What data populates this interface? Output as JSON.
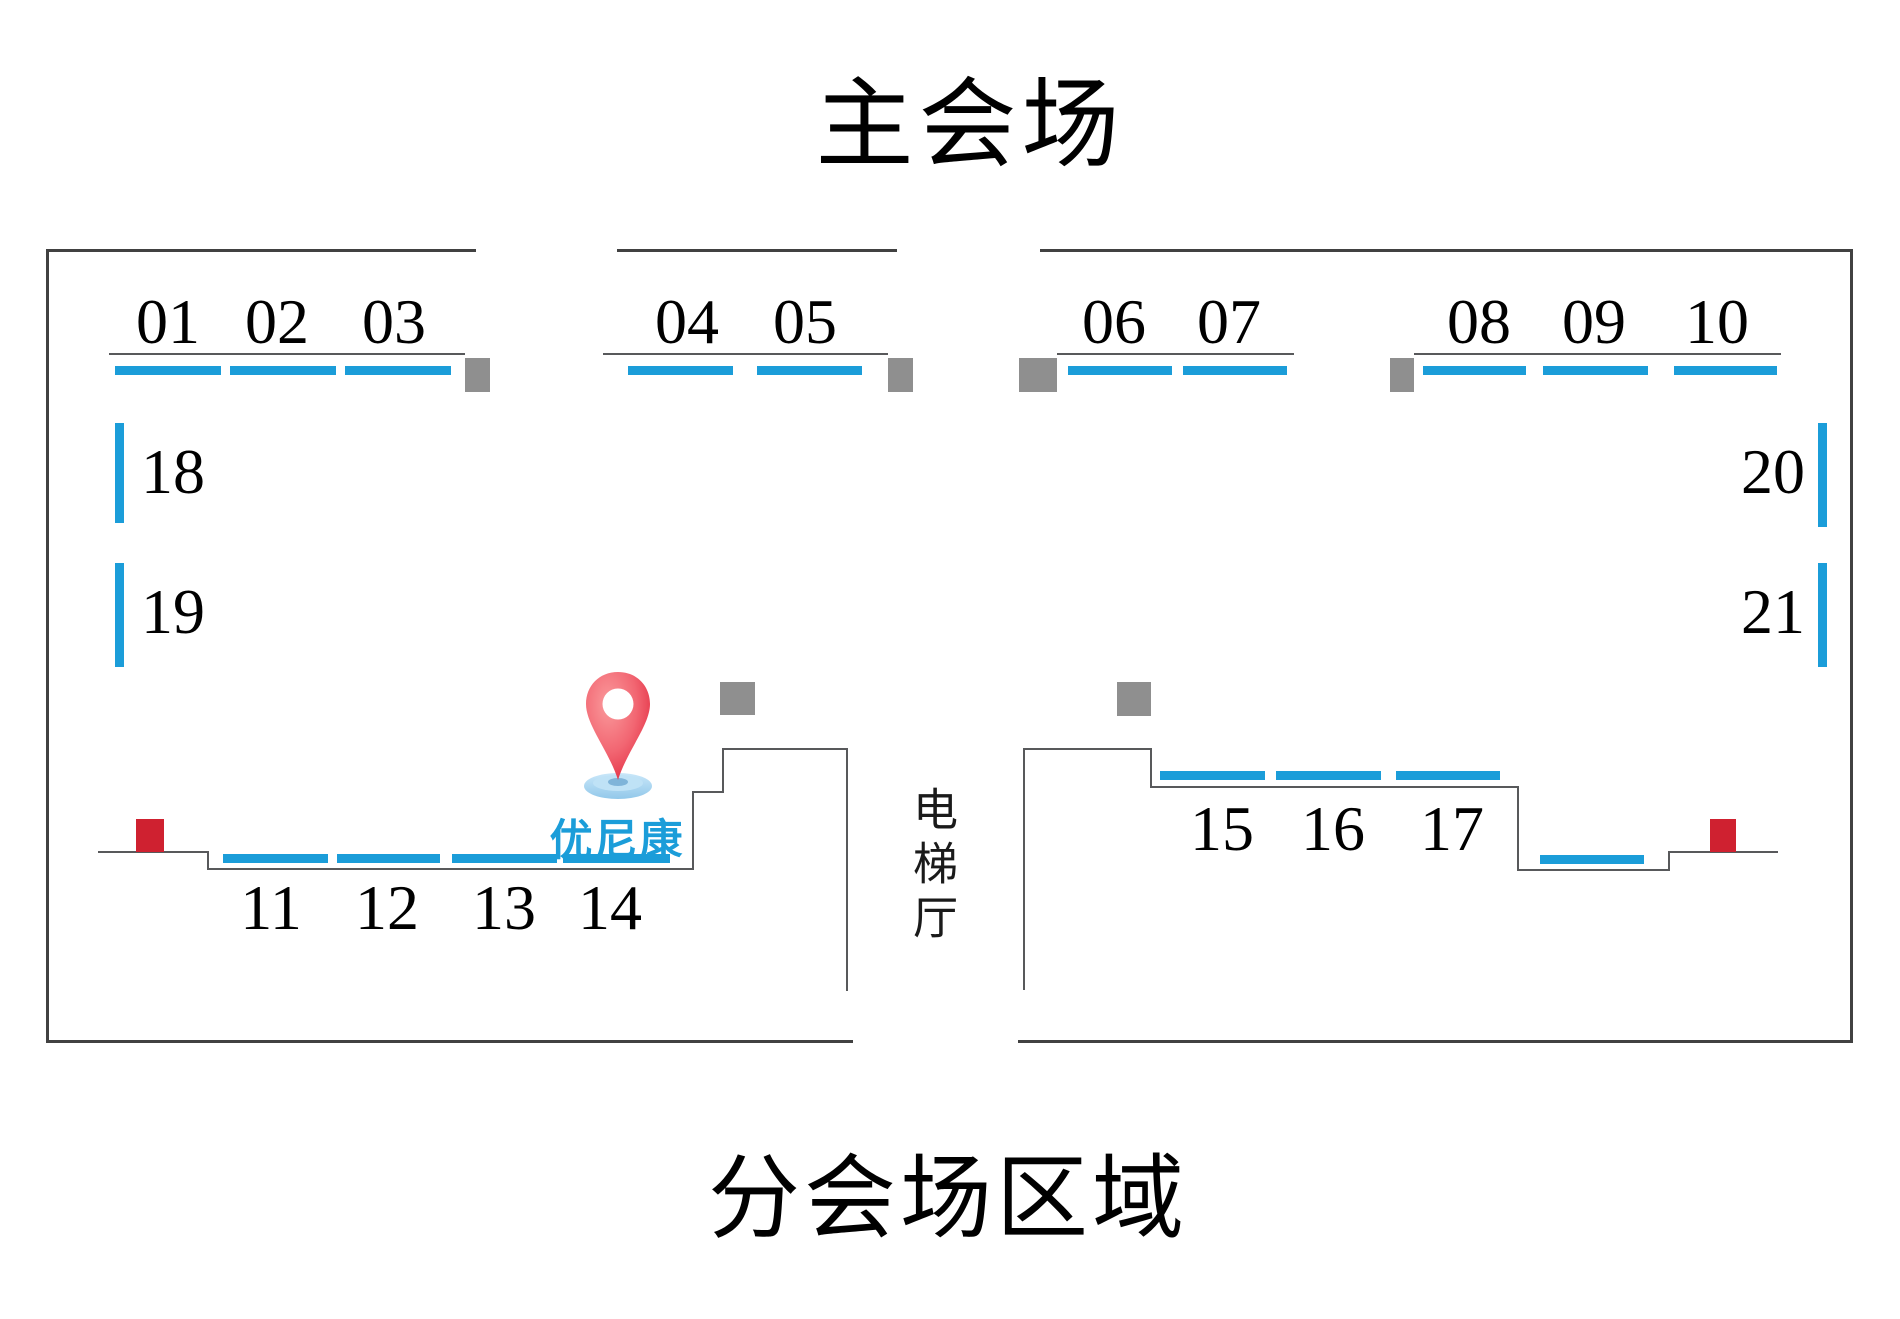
{
  "titles": {
    "main": "主会场",
    "footer": "分会场区域"
  },
  "elevator": {
    "label": "电梯厅"
  },
  "marker": {
    "company": "优尼康",
    "icon": "location-pin"
  },
  "colors": {
    "booth_blue": "#1b9dd9",
    "wall_outer": "#414141",
    "wall_inner": "#58595b",
    "gray_block": "#8f8f8f",
    "red_block": "#cf2130",
    "pin_red_light": "#fa8d90",
    "pin_red_dark": "#e22c41",
    "pin_base_blue": "#a6d6f2",
    "text_black": "#000000"
  },
  "floorplan": {
    "outer_walls": [
      [
        46,
        249,
        430,
        3
      ],
      [
        617,
        249,
        280,
        3
      ],
      [
        1040,
        249,
        813,
        3
      ],
      [
        46,
        249,
        3,
        794
      ],
      [
        1850,
        249,
        3,
        794
      ],
      [
        46,
        1040,
        807,
        3
      ],
      [
        1018,
        1040,
        835,
        3
      ]
    ],
    "inner_walls": [
      [
        109,
        353,
        356,
        2
      ],
      [
        603,
        353,
        285,
        2
      ],
      [
        1057,
        353,
        237,
        2
      ],
      [
        1414,
        353,
        367,
        2
      ],
      [
        98,
        851,
        110,
        2
      ],
      [
        207,
        851,
        2,
        19
      ],
      [
        207,
        868,
        487,
        2
      ],
      [
        692,
        793,
        2,
        77
      ],
      [
        692,
        791,
        32,
        2
      ],
      [
        722,
        750,
        2,
        43
      ],
      [
        722,
        748,
        126,
        2
      ],
      [
        846,
        750,
        2,
        241
      ],
      [
        1023,
        750,
        2,
        240
      ],
      [
        1023,
        748,
        129,
        2
      ],
      [
        1150,
        748,
        2,
        40
      ],
      [
        1150,
        786,
        368,
        2
      ],
      [
        1517,
        786,
        2,
        85
      ],
      [
        1517,
        869,
        153,
        2
      ],
      [
        1668,
        851,
        2,
        20
      ],
      [
        1668,
        851,
        110,
        2
      ]
    ],
    "gray_blocks": [
      [
        465,
        358,
        25,
        34
      ],
      [
        888,
        358,
        25,
        34
      ],
      [
        1019,
        358,
        38,
        34
      ],
      [
        1390,
        358,
        24,
        34
      ],
      [
        720,
        682,
        35,
        33
      ],
      [
        1117,
        682,
        34,
        34
      ]
    ],
    "red_blocks": [
      [
        136,
        819,
        28,
        33
      ],
      [
        1710,
        819,
        26,
        33
      ]
    ],
    "booths": [
      {
        "id": "01",
        "bar": [
          115,
          366,
          106,
          9
        ],
        "label_at": [
          168,
          290
        ],
        "align": "center"
      },
      {
        "id": "02",
        "bar": [
          230,
          366,
          106,
          9
        ],
        "label_at": [
          277,
          290
        ],
        "align": "center"
      },
      {
        "id": "03",
        "bar": [
          345,
          366,
          106,
          9
        ],
        "label_at": [
          394,
          290
        ],
        "align": "center"
      },
      {
        "id": "04",
        "bar": [
          628,
          366,
          105,
          9
        ],
        "label_at": [
          687,
          290
        ],
        "align": "center"
      },
      {
        "id": "05",
        "bar": [
          757,
          366,
          105,
          9
        ],
        "label_at": [
          805,
          290
        ],
        "align": "center"
      },
      {
        "id": "06",
        "bar": [
          1068,
          366,
          104,
          9
        ],
        "label_at": [
          1114,
          290
        ],
        "align": "center"
      },
      {
        "id": "07",
        "bar": [
          1183,
          366,
          104,
          9
        ],
        "label_at": [
          1229,
          290
        ],
        "align": "center"
      },
      {
        "id": "08",
        "bar": [
          1423,
          366,
          103,
          9
        ],
        "label_at": [
          1479,
          290
        ],
        "align": "center"
      },
      {
        "id": "09",
        "bar": [
          1543,
          366,
          105,
          9
        ],
        "label_at": [
          1594,
          290
        ],
        "align": "center"
      },
      {
        "id": "10",
        "bar": [
          1674,
          366,
          103,
          9
        ],
        "label_at": [
          1717,
          290
        ],
        "align": "center"
      },
      {
        "id": "18",
        "bar": [
          115,
          423,
          9,
          100
        ],
        "label_at": [
          141,
          440
        ],
        "align": "left"
      },
      {
        "id": "19",
        "bar": [
          115,
          563,
          9,
          104
        ],
        "label_at": [
          141,
          580
        ],
        "align": "left"
      },
      {
        "id": "20",
        "bar": [
          1818,
          423,
          9,
          104
        ],
        "label_at": [
          1741,
          440
        ],
        "align": "left"
      },
      {
        "id": "21",
        "bar": [
          1818,
          563,
          9,
          104
        ],
        "label_at": [
          1741,
          580
        ],
        "align": "left"
      },
      {
        "id": "11",
        "bar": [
          223,
          854,
          105,
          9
        ],
        "label_at": [
          271,
          876
        ],
        "align": "center"
      },
      {
        "id": "12",
        "bar": [
          337,
          854,
          103,
          9
        ],
        "label_at": [
          387,
          876
        ],
        "align": "center"
      },
      {
        "id": "13",
        "bar": [
          452,
          854,
          105,
          9
        ],
        "label_at": [
          504,
          876
        ],
        "align": "center"
      },
      {
        "id": "14",
        "bar": [
          563,
          854,
          107,
          9
        ],
        "label_at": [
          610,
          876
        ],
        "align": "center"
      },
      {
        "id": "15",
        "bar": [
          1160,
          771,
          105,
          9
        ],
        "label_at": [
          1222,
          797
        ],
        "align": "center"
      },
      {
        "id": "16",
        "bar": [
          1276,
          771,
          105,
          9
        ],
        "label_at": [
          1333,
          797
        ],
        "align": "center"
      },
      {
        "id": "17",
        "bar": [
          1396,
          771,
          104,
          9
        ],
        "label_at": [
          1452,
          797
        ],
        "align": "center"
      },
      {
        "id": "",
        "bar": [
          1540,
          855,
          104,
          9
        ]
      }
    ]
  }
}
